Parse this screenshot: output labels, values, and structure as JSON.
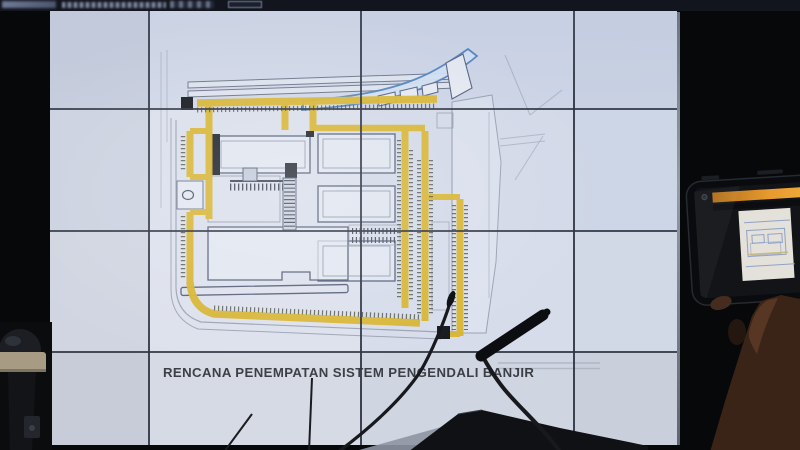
{
  "screen": {
    "title": "RENCANA PENEMPATAN SISTEM PENGENDALI BANJIR"
  },
  "video_wall": {
    "rows": 4,
    "columns": 4
  },
  "objects": [
    "video-wall",
    "site-plan-slide",
    "flood-control-plan-drawing",
    "gooseneck-microphone-left",
    "gooseneck-microphone-right",
    "podium-desk",
    "dome-camera",
    "smartphone-recording",
    "hand-holding-phone",
    "top-bezel-bar"
  ],
  "colors": {
    "background": "#07080a",
    "panel": "#d2d8e6",
    "seam": "#2e3543",
    "road_highlight": "#d8b531",
    "road_hatch": "#4a4f45",
    "river_blue": "#4d7fc0",
    "plan_line": "#55607a",
    "plan_dark": "#15181e",
    "title_text": "#3c3f45",
    "phone_ui_bar": "#d8892a",
    "phone_body": "#0a0b0e",
    "hand_skin": "#5d3b27",
    "camera_base": "#a89b84",
    "desk": "#101114"
  }
}
